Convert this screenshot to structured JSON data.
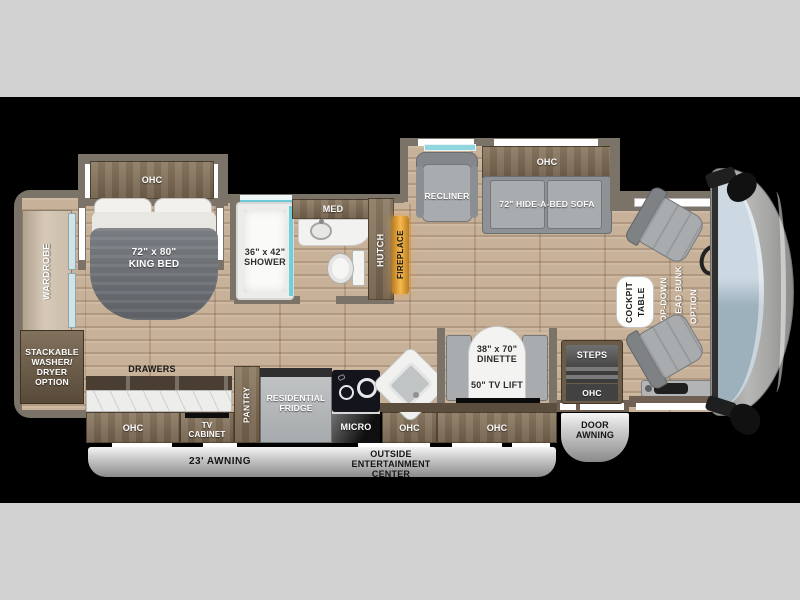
{
  "title": "Class A motorhome floor plan",
  "labels": {
    "bedroom": {
      "ohc": "OHC",
      "bed": "72\" x 80\"\nKING BED",
      "wardrobe": "WARDROBE",
      "washer_dryer": "STACKABLE\nWASHER/\nDRYER\nOPTION",
      "drawers": "DRAWERS"
    },
    "bath": {
      "shower": "36\" x 42\"\nSHOWER",
      "med": "MED",
      "hutch": "HUTCH",
      "fireplace": "FIREPLACE"
    },
    "living": {
      "recliner": "RECLINER",
      "sofa_ohc": "OHC",
      "sofa": "72\" HIDE-A-BED SOFA"
    },
    "dinette": {
      "size": "38\" x 70\"\nDINETTE",
      "tv_lift": "50\" TV LIFT",
      "ohc": "OHC"
    },
    "kitchen": {
      "ohc_left": "OHC",
      "tv_cabinet": "TV\nCABINET",
      "pantry": "PANTRY",
      "fridge": "RESIDENTIAL\nFRIDGE",
      "micro": "MICRO",
      "ohc_mid": "OHC"
    },
    "entry": {
      "steps": "STEPS",
      "steps_ohc": "OHC",
      "door_awning": "DOOR\nAWNING"
    },
    "cockpit": {
      "table": "COCKPIT\nTABLE",
      "bunk": "DROP-DOWN\nOVERHEAD BUNK\nOPTION"
    },
    "exterior": {
      "awning": "23' AWNING",
      "entertainment": "OUTSIDE\nENTERTAINMENT\nCENTER"
    }
  },
  "colors": {
    "page_background": "#d2d2d2",
    "image_band": "#000000",
    "wood_floor": "#c8b199",
    "wall_gray": "#7b7268",
    "cabinet_brown": "#7a6a54",
    "accent_teal": "#6fd0da",
    "fireplace_glow": "#f6b84e",
    "windshield_blue": "#b9cbd6",
    "awning_silver": "#c9c9c9",
    "furniture_gray": "#a9acae"
  }
}
